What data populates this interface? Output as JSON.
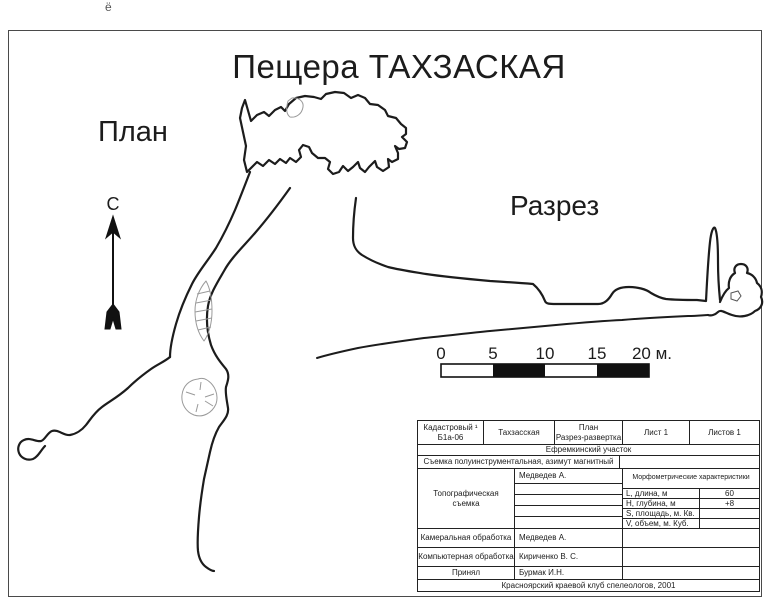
{
  "annotation": {
    "top_note": "ё"
  },
  "header": {
    "title": "Пещера ТАХЗАСКАЯ"
  },
  "labels": {
    "plan": "План",
    "section": "Разрез",
    "north": "С"
  },
  "scale_bar": {
    "labels": [
      "0",
      "5",
      "10",
      "15",
      "20 м."
    ]
  },
  "info_table": {
    "row1": {
      "cadastral_line1": "Кадастровый ¹",
      "cadastral_line2": "Б1а-06",
      "name": "Тахзасская",
      "type_line1": "План",
      "type_line2": "Разрез-развертка",
      "sheet": "Лист 1",
      "sheets": "Листов 1"
    },
    "area": "Ефремкинский участок",
    "survey_method": "Съемка полуинструментальная, азимут магнитный",
    "topo": {
      "label_line1": "Топографическая",
      "label_line2": "съемка",
      "surveyor": "Медведев А."
    },
    "morpho": {
      "header": "Морфометрические характеристики",
      "rows": [
        {
          "label": "L, длина, м",
          "value": "60"
        },
        {
          "label": "Н, глубина, м",
          "value": "+8"
        },
        {
          "label": "S, площадь, м. Кв.",
          "value": ""
        },
        {
          "label": "V, объем, м. Куб.",
          "value": ""
        }
      ]
    },
    "processing": [
      {
        "label": "Камеральная обработка",
        "value": "Медведев А."
      },
      {
        "label": "Компьютерная обработка",
        "value": "Кириченко В. С."
      },
      {
        "label": "Принял",
        "value": "Бурмак И.Н."
      }
    ],
    "footer": "Красноярский краевой клуб спелеологов, 2001"
  },
  "colors": {
    "ink": "#1c1c1c",
    "light_ink": "#9a9a9a",
    "frame": "#4a4a4a"
  }
}
